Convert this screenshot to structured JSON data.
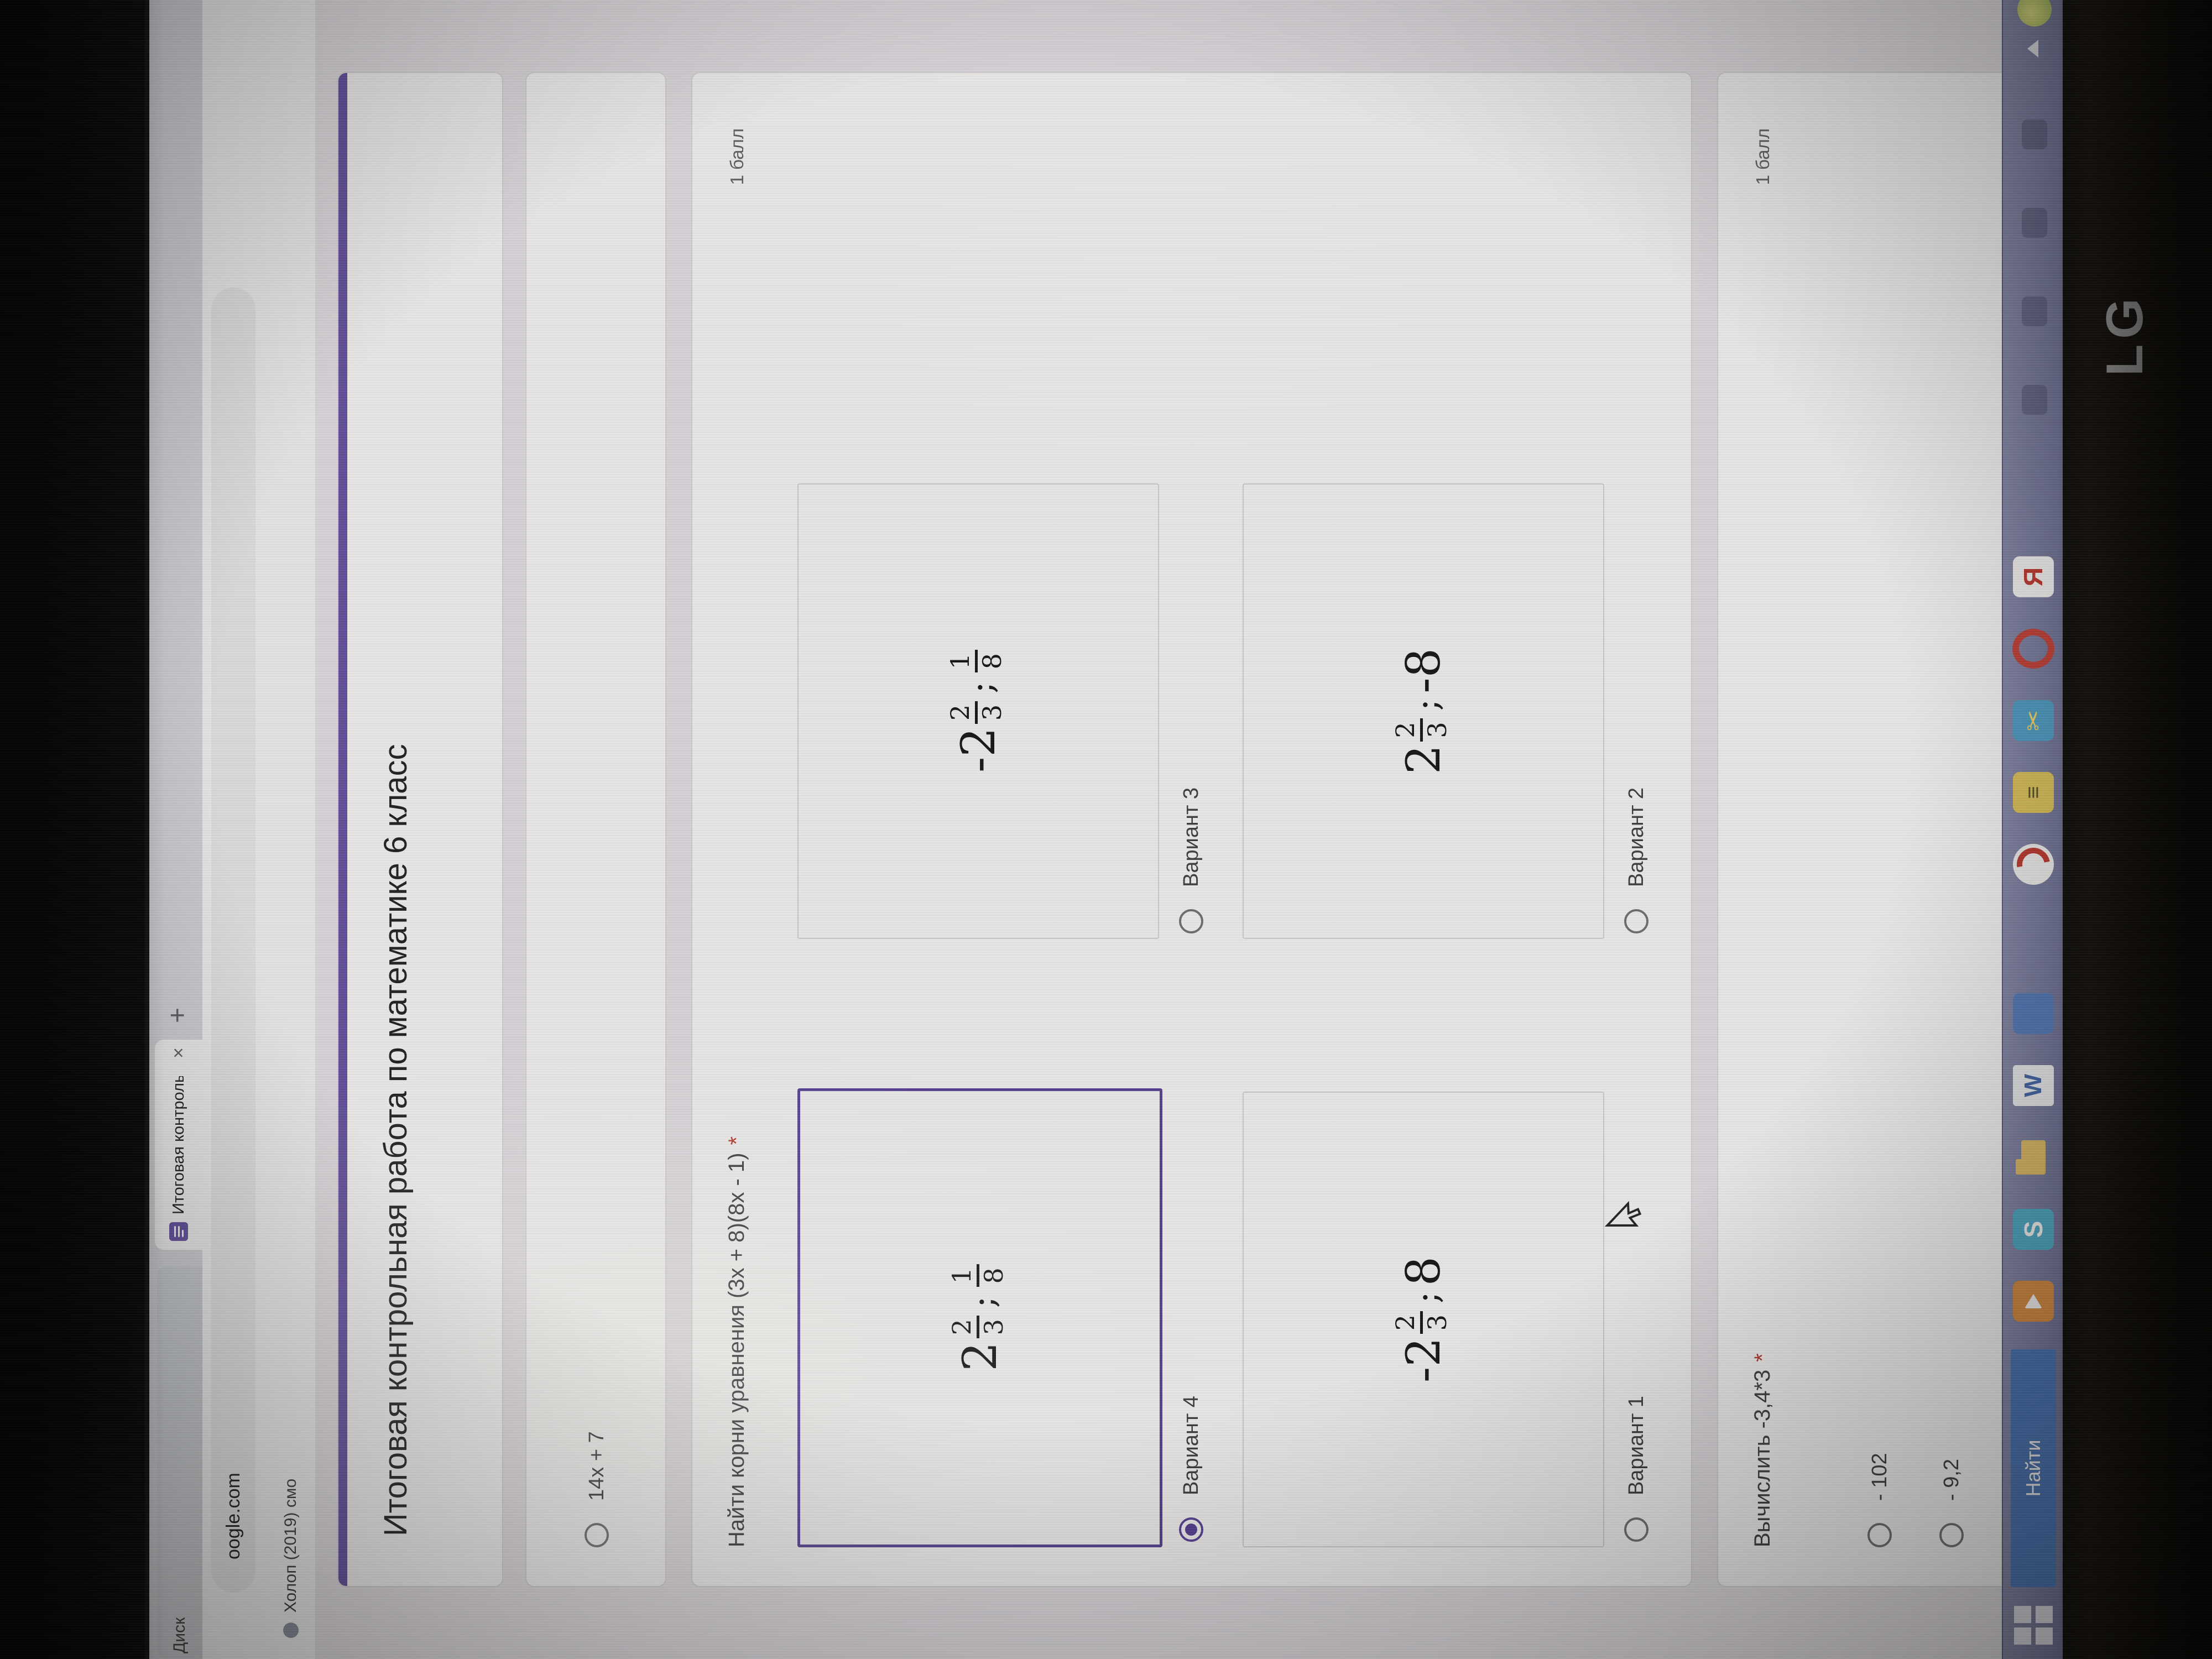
{
  "browser": {
    "tabs": [
      {
        "label": "Диск"
      },
      {
        "label": "Итоговая контрольная",
        "close_glyph": "×"
      }
    ],
    "new_tab_glyph": "+",
    "url_visible": "oogle.com",
    "bookmark": {
      "label": "Холоп (2019) смо"
    }
  },
  "form": {
    "title": "Итоговая контрольная работа по математике 6 класс",
    "q1": {
      "options": [
        {
          "label": "14x + 7"
        }
      ]
    },
    "q2": {
      "question": "Найти корни уравнения (3x + 8)(8x - 1)",
      "required_mark": "*",
      "points": "1 балл",
      "options": [
        {
          "label": "Вариант 4",
          "selected": true,
          "math": {
            "head": "2",
            "n1": "2",
            "d1": "3",
            "sep": ";",
            "n2": "1",
            "d2": "8",
            "tail": ""
          }
        },
        {
          "label": "Вариант 3",
          "selected": false,
          "math": {
            "head": "-2",
            "n1": "2",
            "d1": "3",
            "sep": ";",
            "n2": "1",
            "d2": "8",
            "tail": ""
          }
        },
        {
          "label": "Вариант 1",
          "selected": false,
          "math": {
            "head": "-2",
            "n1": "2",
            "d1": "3",
            "sep": ";",
            "n2": "",
            "d2": "",
            "tail": "8"
          }
        },
        {
          "label": "Вариант 2",
          "selected": false,
          "math": {
            "head": "2",
            "n1": "2",
            "d1": "3",
            "sep": ";",
            "n2": "",
            "d2": "",
            "tail": "-8"
          }
        }
      ]
    },
    "q3": {
      "question": "Вычислить -3,4*3",
      "required_mark": "*",
      "points": "1 балл",
      "options": [
        {
          "label": "- 102"
        },
        {
          "label": "- 9,2"
        }
      ]
    },
    "accent_color": "#6b4fbb",
    "selected_color": "#5d3fb2",
    "required_color": "#d93025"
  },
  "taskbar": {
    "search_label": "Найти",
    "skype_letter": "S",
    "word_letter": "W",
    "yandex_letter": "Я",
    "snip_glyph": "✂",
    "media_glyph": "≡"
  },
  "bezel": {
    "logo": "LG"
  }
}
